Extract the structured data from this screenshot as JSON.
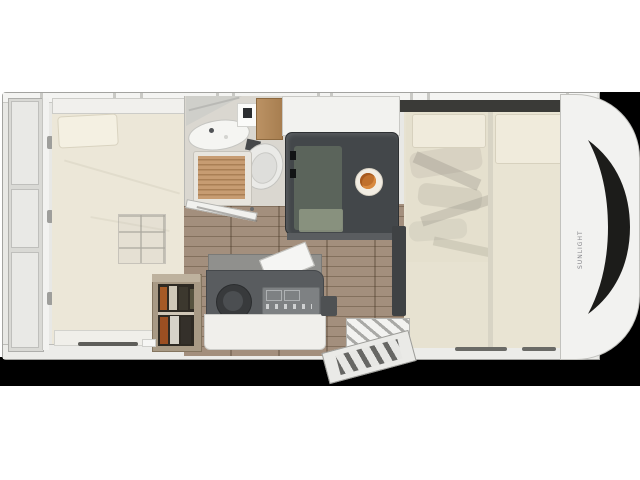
{
  "brand": {
    "vertical_text": "SUNLIGHT"
  },
  "palette": {
    "backdrop": "#000000",
    "body": "#e8e8e5",
    "bed": "#ece7d8",
    "bathfloor": "#dad7d0",
    "slat": "#c79c72",
    "slatgap": "#aa7f55",
    "wood": "#9c8773",
    "table": "#43474a",
    "bench": "#6f7b69",
    "plate": "#f2ede3",
    "food": "#c0702c",
    "counter": "#595c5f",
    "stove": "#7e8183",
    "frontbed": "#e7e2d1",
    "windshield": "#1c1c1a"
  }
}
